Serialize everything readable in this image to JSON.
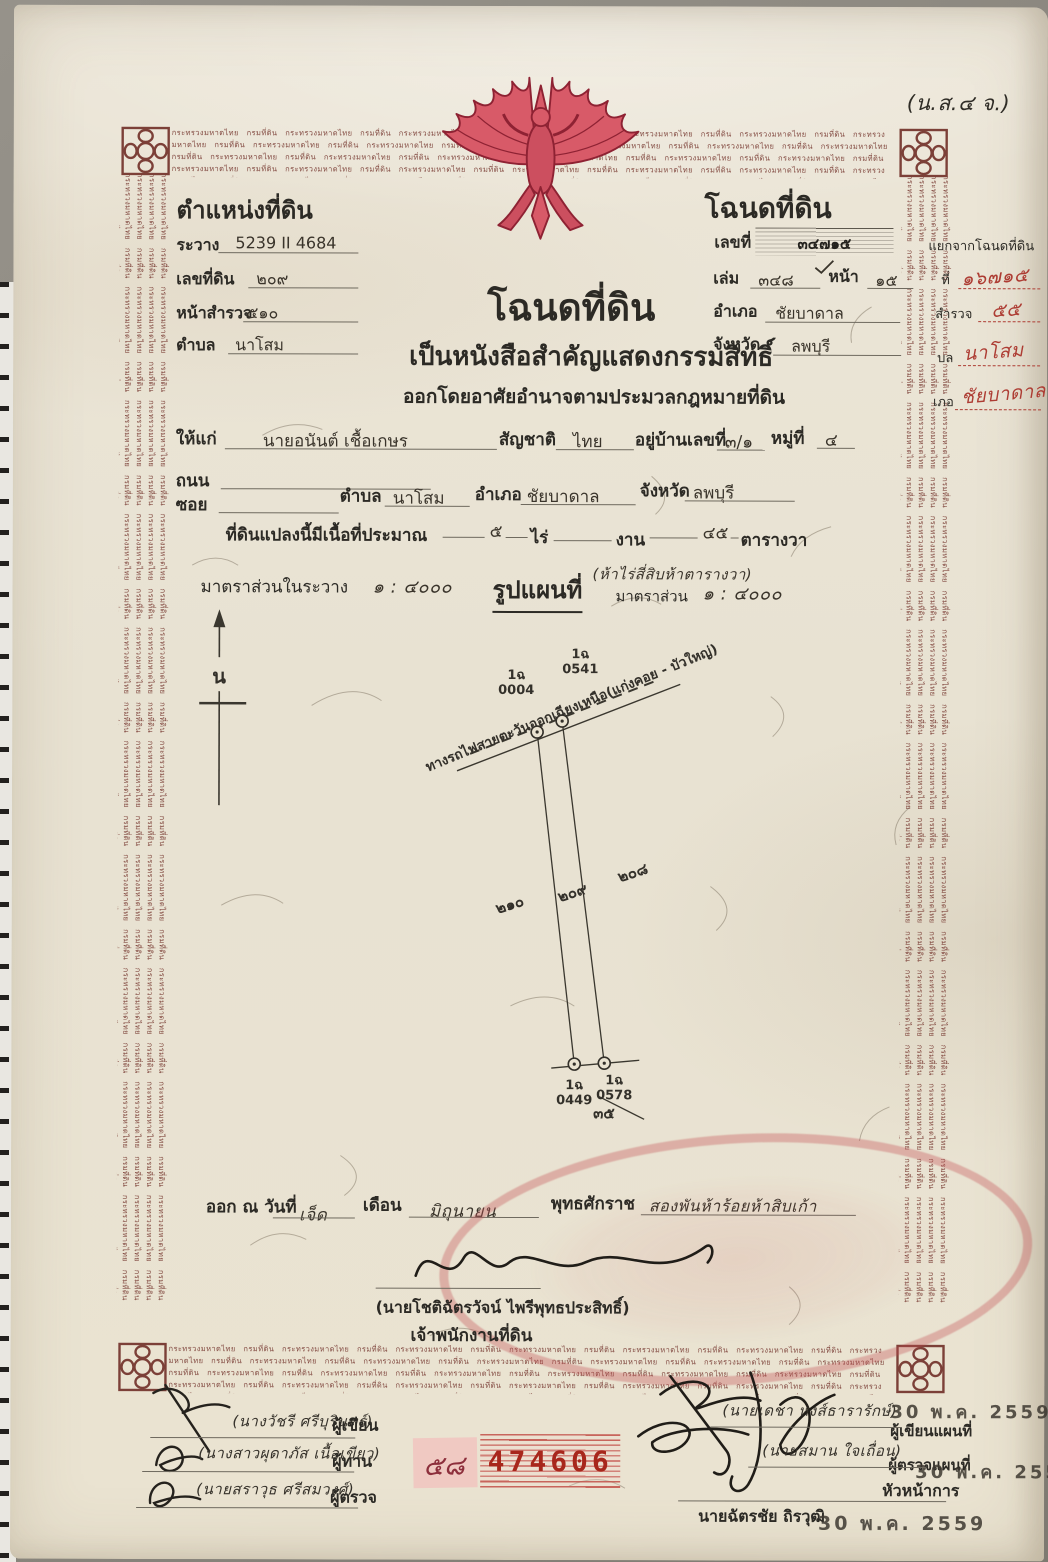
{
  "form_code": "(น.ส.๔ จ.)",
  "border": {
    "micro_text": "กระทรวงมหาดไทย กรมที่ดิน"
  },
  "left_block": {
    "title": "ตำแหน่งที่ดิน",
    "rawang_label": "ระวาง",
    "rawang_value": "5239 II 4684",
    "land_no_label": "เลขที่ดิน",
    "land_no_value": "๒๐๙",
    "survey_page_label": "หน้าสำรวจ",
    "survey_page_value": "๕๑๐",
    "tambon_label": "ตำบล",
    "tambon_value": "นาโสม"
  },
  "right_block": {
    "title": "โฉนดที่ดิน",
    "deed_no_label": "เลขที่",
    "deed_no_value": "๓๔๗๑๕",
    "volume_label": "เล่ม",
    "volume_value": "๓๔๘",
    "page_label": "หน้า",
    "page_value": "๑๕",
    "amphoe_label": "อำเภอ",
    "amphoe_value": "ชัยบาดาล",
    "province_label": "จังหวัด",
    "province_value": "ลพบุรี"
  },
  "margin_notes": {
    "split_label": "แยกจากโฉนดที่ดิน",
    "no_label": "ที่",
    "no_value": "๑๖๗๑๕",
    "survey_label": "สำรวจ",
    "survey_value": "๕๕",
    "tambon_label": "บล",
    "tambon_value": "นาโสม",
    "amphoe_label": "เภอ",
    "amphoe_value": "ชัยบาดาล"
  },
  "center": {
    "main_title": "โฉนดที่ดิน",
    "subtitle1": "เป็นหนังสือสำคัญแสดงกรรมสิทธิ์",
    "subtitle2": "ออกโดยอาศัยอำนาจตามประมวลกฎหมายที่ดิน"
  },
  "grantee": {
    "given_to_label": "ให้แก่",
    "name": "นายอนันต์ เชื้อเกษร",
    "nationality_label": "สัญชาติ",
    "nationality": "ไทย",
    "address_label": "อยู่บ้านเลขที่",
    "address_no": "๓/๑",
    "moo_label": "หมู่ที่",
    "moo_value": "๔",
    "road_label": "ถนน",
    "soi_label": "ซอย",
    "tambon_label": "ตำบล",
    "tambon_value": "นาโสม",
    "amphoe_label": "อำเภอ",
    "amphoe_value": "ชัยบาดาล",
    "province_label": "จังหวัด",
    "province_value": "ลพบุรี"
  },
  "area": {
    "prefix": "ที่ดินแปลงนี้มีเนื้อที่ประมาณ",
    "rai_value": "๕",
    "rai_label": "ไร่",
    "ngan_value": "",
    "ngan_label": "งาน",
    "wah_value": "๔๕",
    "wah_label": "ตารางวา",
    "handwritten_note": "(ห้าไร่สี่สิบห้าตารางวา)"
  },
  "map": {
    "scale_label": "มาตราส่วนในระวาง",
    "scale_value": "๑ : ๔๐๐๐",
    "map_title": "รูปแผนที่",
    "scale2_label": "มาตราส่วน",
    "scale2_value": "๑ : ๔๐๐๐",
    "north_letter": "น",
    "railway_label": "ทางรถไฟสายตะวันออกเฉียงเหนือ(แก่งคอย - บัวใหญ่)",
    "marker_tl_code": "1ฉ",
    "marker_tl_no": "0004",
    "marker_tr_code": "1ฉ",
    "marker_tr_no": "0541",
    "marker_bl_code": "1ฉ",
    "marker_bl_no": "0449",
    "marker_br_code": "1ฉ",
    "marker_br_no": "0578",
    "parcel_left": "๒๑๐",
    "parcel_center": "๒๐๙",
    "parcel_right": "๒๐๘",
    "bottom_number": "๓๕"
  },
  "issuance": {
    "prefix": "ออก ณ วันที่",
    "day_value": "เจ็ด",
    "month_label": "เดือน",
    "month_value": "มิถุนายน",
    "era_label": "พุทธศักราช",
    "year_value": "สองพันห้าร้อยห้าสิบเก้า",
    "officer_name": "(นายโชติฉัตรวัจน์ ไพรีพุทธประสิทธิ์)",
    "officer_title": "เจ้าพนักงานที่ดิน"
  },
  "signatures_left": [
    {
      "name": "(นางวัชรี ศรีบุรินทร์)",
      "role": "ผู้เขียน"
    },
    {
      "name": "(นางสาวผุดาภัส เนื้อเขียว)",
      "role": "ผู้ทาน"
    },
    {
      "name": "(นายสราวุธ ศรีสมวงศ์)",
      "role": "ผู้ตรวจ"
    }
  ],
  "signatures_right": [
    {
      "name": "(นายเดชา หงส์ธารารักษ์)",
      "role": "ผู้เขียนแผนที่",
      "date_stamp": "30 พ.ค. 2559"
    },
    {
      "name": "(นายสมาน ใจเถื่อน)",
      "role": "ผู้ตรวจแผนที่",
      "date_stamp": "30 พ.ค. 2559"
    },
    {
      "name": "นายฉัตรชัย ถิรวุฒิ",
      "role": "หัวหน้าการ",
      "date_stamp": "30 พ.ค. 2559"
    }
  ],
  "serial": {
    "handwritten": "๕๘",
    "number": "474606"
  },
  "colors": {
    "paper": "#eae3d1",
    "border_text": "#7c4038",
    "garuda_red": "#d85a68",
    "seal_red": "#c14a4e",
    "serial_red": "#a8271c",
    "ink": "#2c2a25",
    "red_ink": "#ad3c33"
  }
}
